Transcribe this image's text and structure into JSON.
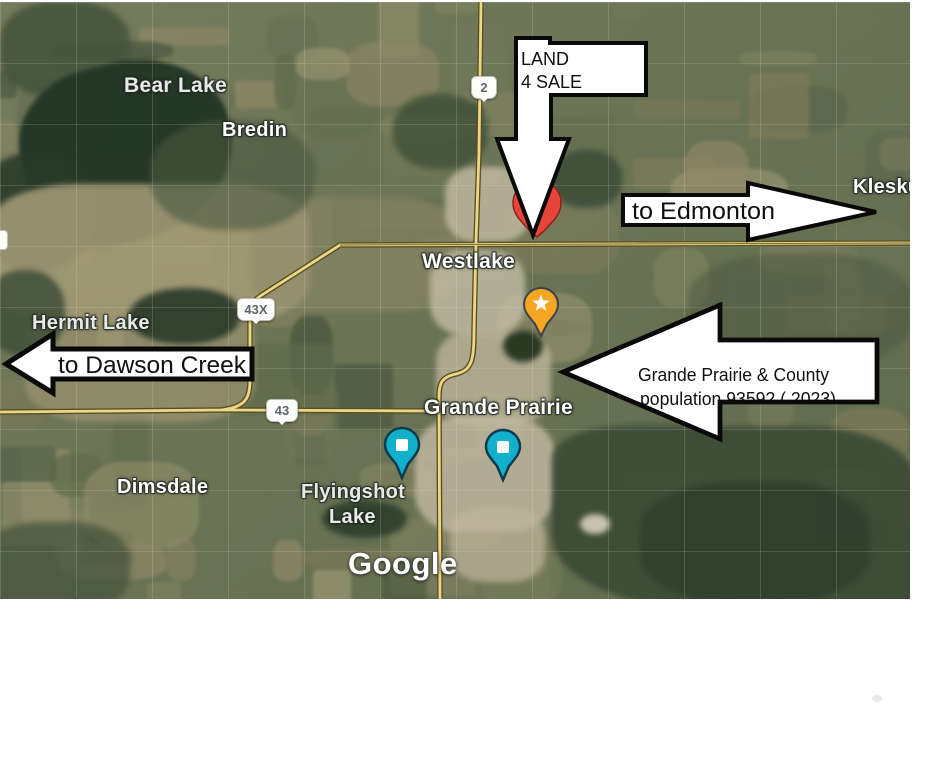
{
  "map": {
    "attribution": "Google",
    "labels": [
      {
        "id": "bear-lake",
        "text": "Bear Lake"
      },
      {
        "id": "bredin",
        "text": "Bredin"
      },
      {
        "id": "kleskun",
        "text": "Klesku"
      },
      {
        "id": "westlake",
        "text": "Westlake"
      },
      {
        "id": "hermit-lake",
        "text": "Hermit Lake"
      },
      {
        "id": "grande-prairie",
        "text": "Grande Prairie"
      },
      {
        "id": "dimsdale",
        "text": "Dimsdale"
      },
      {
        "id": "flyingshot-line1",
        "text": "Flyingshot"
      },
      {
        "id": "flyingshot-line2",
        "text": "Lake"
      }
    ],
    "shields": [
      {
        "label": "2"
      },
      {
        "label": "43X"
      },
      {
        "label": "43"
      }
    ],
    "markers": [
      {
        "name": "red-pin",
        "color": "#e8443a"
      },
      {
        "name": "star-pin",
        "color": "#f6a623"
      },
      {
        "name": "teal-pin-1",
        "color": "#12b0ca"
      },
      {
        "name": "teal-pin-2",
        "color": "#12b0ca"
      }
    ]
  },
  "annotations": {
    "land_sale": {
      "line1": "LAND",
      "line2": "4 SALE"
    },
    "to_edmonton": {
      "text": "to Edmonton"
    },
    "to_dawson_creek": {
      "text": "to Dawson Creek"
    },
    "grande_prairie_county": {
      "line1": "Grande Prairie & County",
      "line2": "population 93592 ( 2023)"
    }
  },
  "colors": {
    "road": "#ecd68b",
    "road_outline": "#59501f",
    "water": "#243626",
    "annotation_fill": "#ffffff",
    "annotation_border": "#0a0a0a"
  }
}
